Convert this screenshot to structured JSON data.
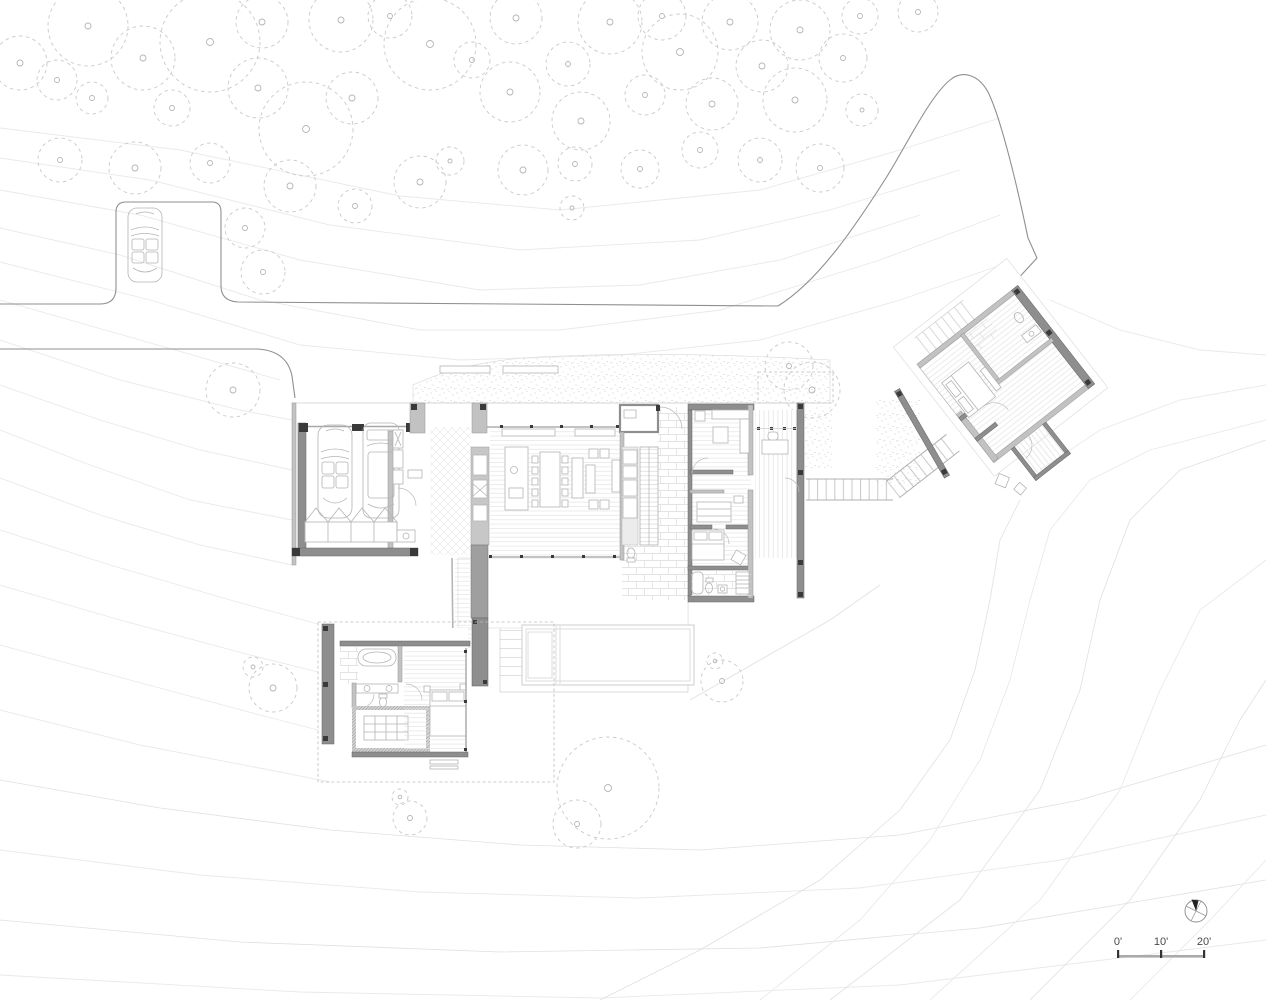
{
  "scale_bar": {
    "labels": [
      "0'",
      "10'",
      "20'"
    ]
  },
  "icons": {
    "north_arrow": "north-arrow-icon"
  },
  "colors": {
    "paper": "#ffffff",
    "contour": "#e9e9e9",
    "tree": "#c9c9c9",
    "driveway": "#8f8f8f",
    "wall_dark": "#8e8e8e",
    "wall_mid": "#c2c2c2",
    "furniture": "#b4b4b4",
    "floor_line": "#e3e3e3",
    "text": "#4a4a4a"
  }
}
